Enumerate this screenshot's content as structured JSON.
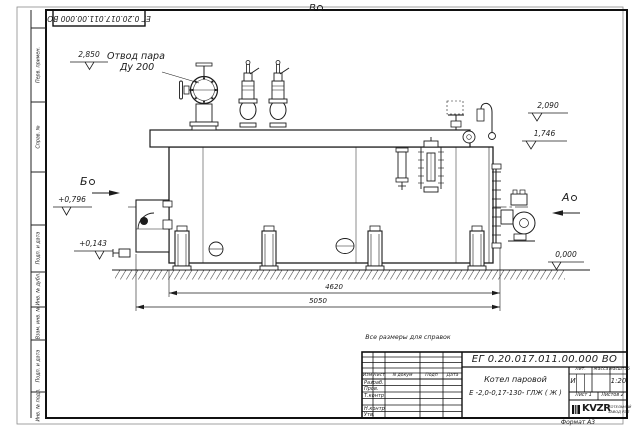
{
  "frame": {
    "top_stamp": "ЕГ 0.20.017.011.00.000  ВО",
    "format_note": "Формат А3",
    "margin_boxes": [
      {
        "label": "Перв. примен."
      },
      {
        "label": "Справ. №"
      },
      {
        "label": "Подп. и дата"
      },
      {
        "label": "Инв. № дубл."
      },
      {
        "label": "Взам. инв. №"
      },
      {
        "label": "Подп. и дата"
      },
      {
        "label": "Инв. № подл."
      }
    ]
  },
  "drawing": {
    "callout_steam": {
      "line1": "Отвод пара",
      "line2": "Ду 200"
    },
    "views": {
      "top": "В",
      "left": "Б",
      "right": "А"
    },
    "elevations": {
      "e2850": "2,850",
      "e2090": "2,090",
      "e1746": "1,746",
      "e0796": "+0,796",
      "e0143": "+0,143",
      "e0000": "0,000"
    },
    "dimensions": {
      "inner": "4620",
      "overall": "5050"
    },
    "note": "Все размеры для справок"
  },
  "title_block": {
    "doc_number": "ЕГ 0.20.017.011.00.000  ВО",
    "name_line1": "Котел паровой",
    "name_line2": "Е -2,0-0,17-130- ГЛЖ ( Ж )",
    "change_header": {
      "izm": "Изм",
      "list": "Лист",
      "doc": "N докум",
      "podp": "Подп",
      "data": "Дата"
    },
    "signature_rows": [
      "Разраб.",
      "Пров.",
      "Т.контр",
      "Н.контр",
      "Утв."
    ],
    "lit_header": "Лит.",
    "mass_header": "Масса",
    "scale_header": "Масштаб",
    "lit_value": "И",
    "scale_value": "1:20",
    "sheet": "Лист 1",
    "sheets": "Листов 2",
    "logo_text": "KVZR",
    "company_line1": "КОТЕЛЬНЫЙ",
    "company_line2": "ЗАВОД РЭП"
  }
}
